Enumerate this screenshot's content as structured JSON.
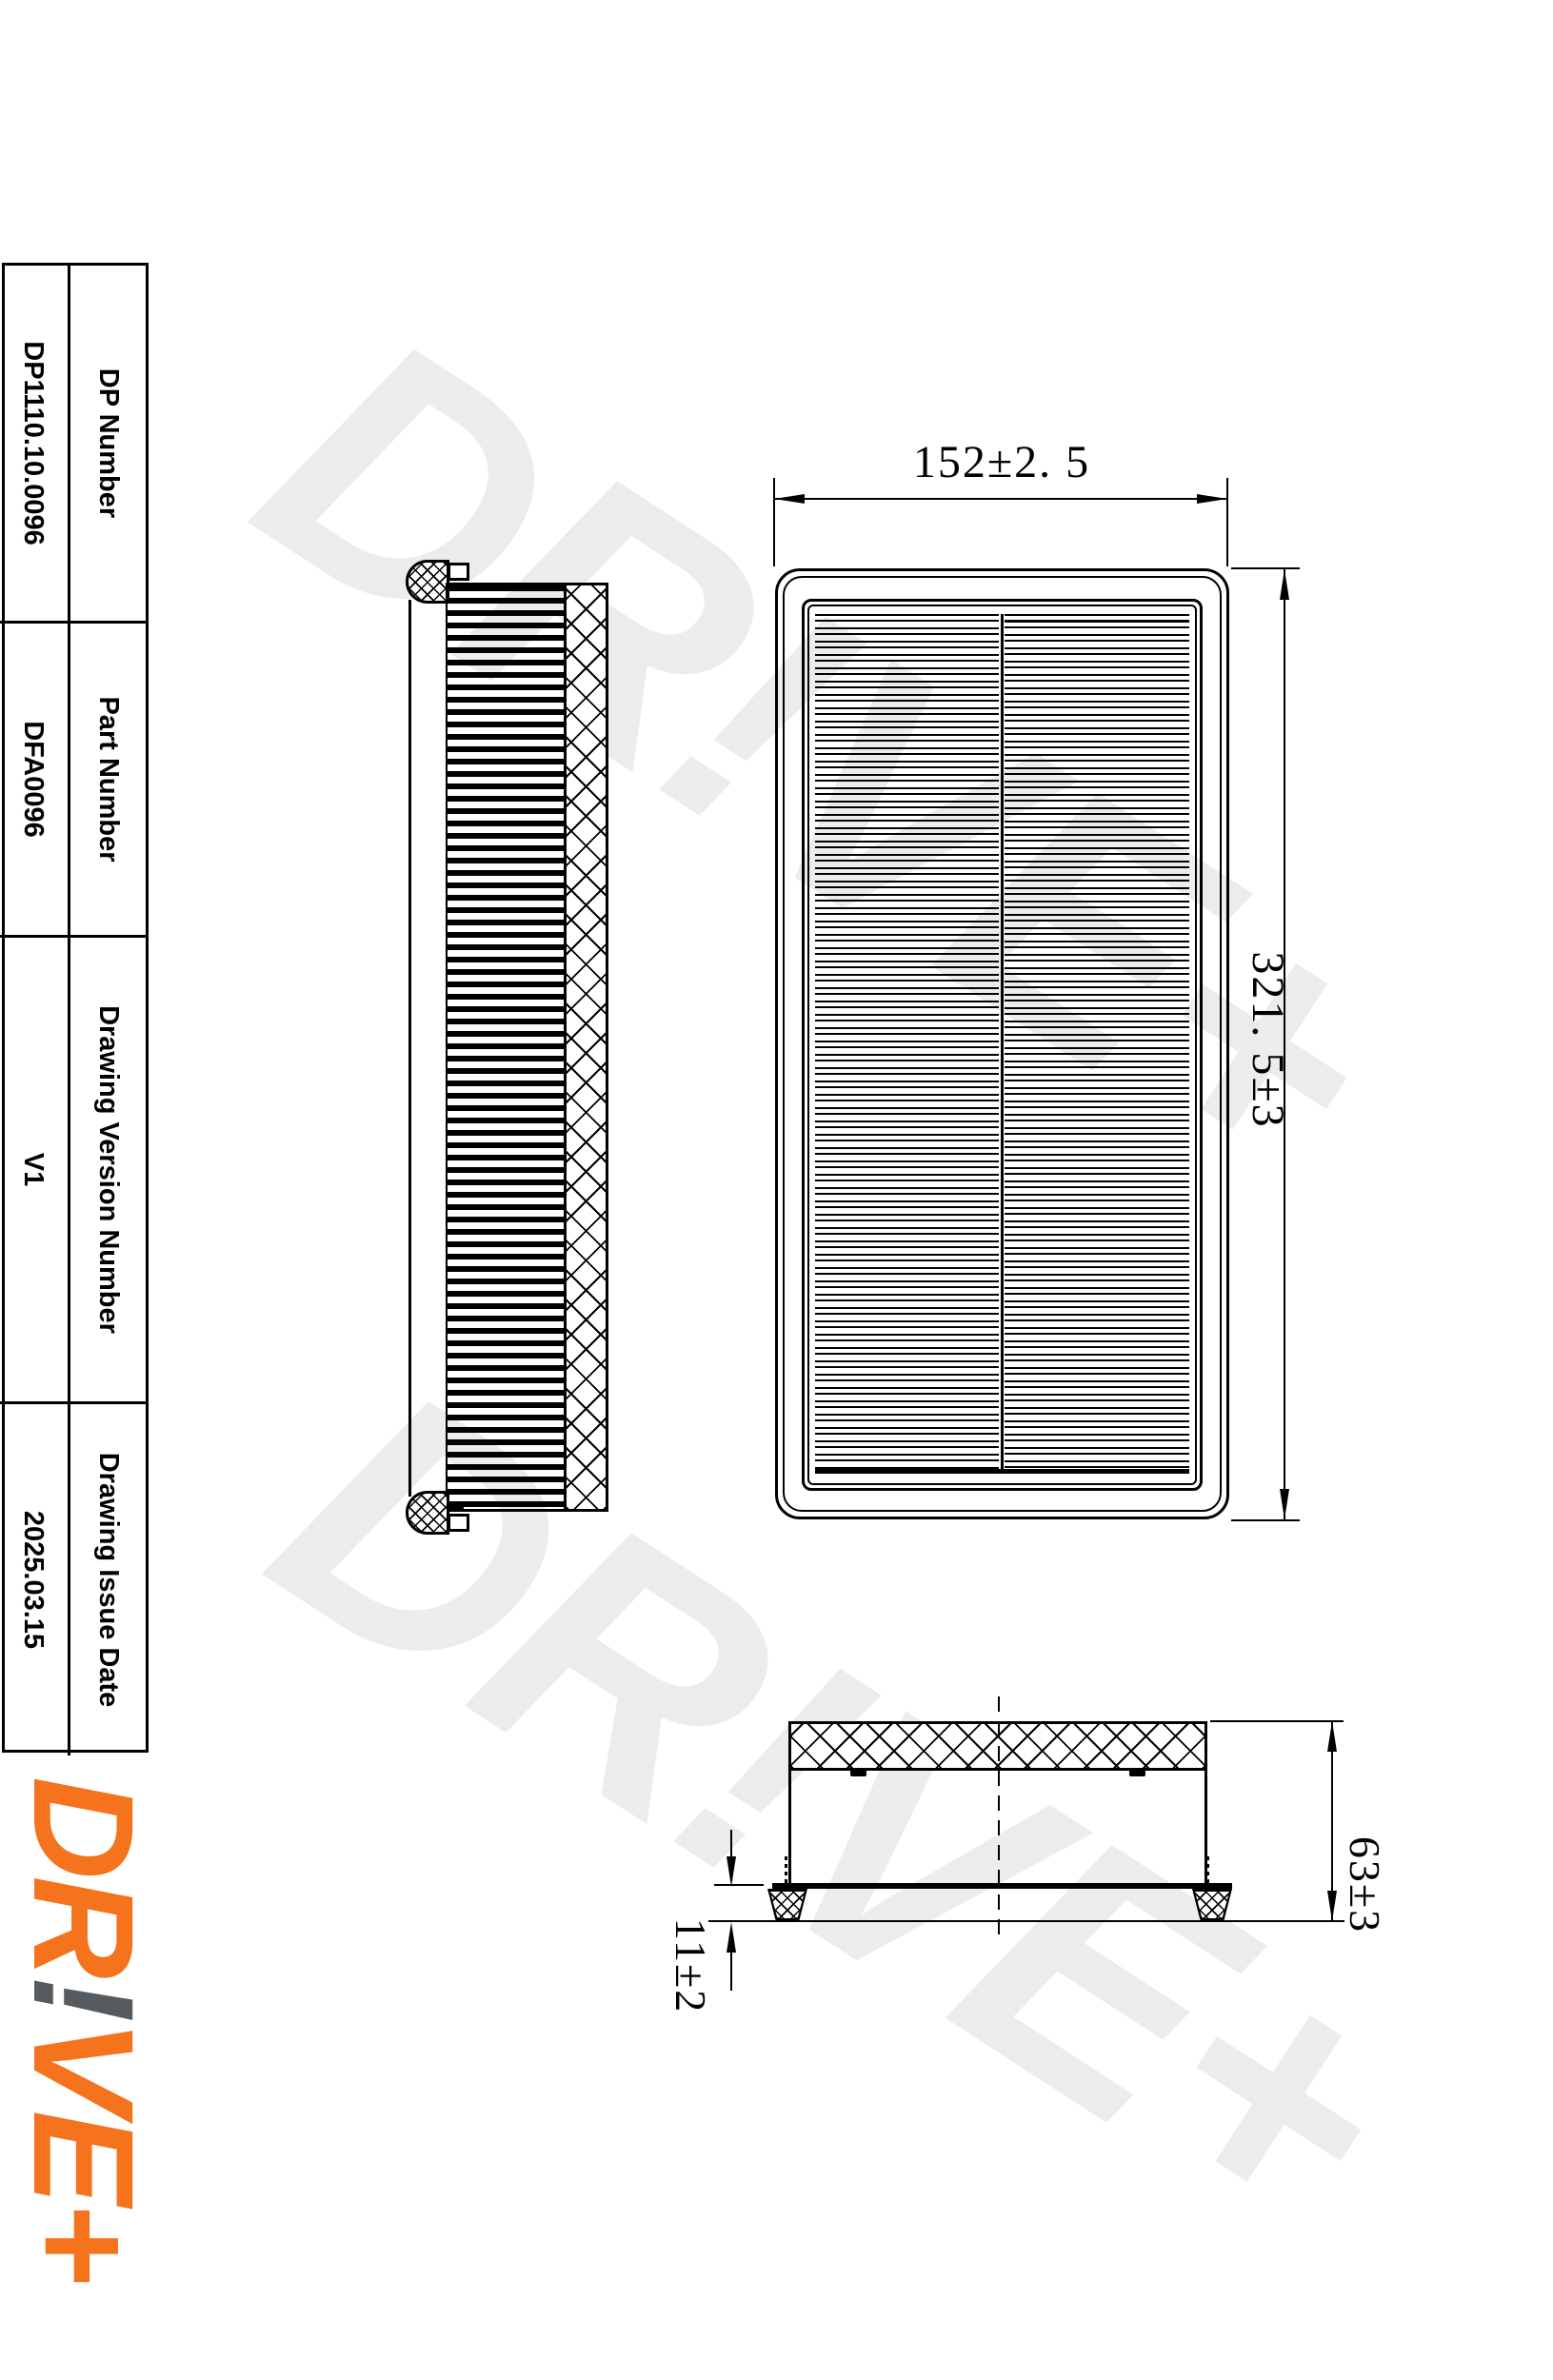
{
  "watermark": {
    "text": "DR!VE+",
    "color": "#ececec"
  },
  "info_table": {
    "rows": [
      {
        "label": "DP Number",
        "value": "DP1110.10.0096"
      },
      {
        "label": "Part Number",
        "value": "DFA0096"
      },
      {
        "label": "Drawing Version Number",
        "value": "V1"
      },
      {
        "label": "Drawing Issue Date",
        "value": "2025.03.15"
      }
    ]
  },
  "logo": {
    "dr": "DR",
    "bang": "!",
    "vep": "VE+",
    "orange_color": "#f4731c",
    "gray_color": "#565b5f"
  },
  "dimensions": {
    "width": "152±2. 5",
    "height": "321. 5±3",
    "depth": "63±3",
    "foot_height": "11±2"
  }
}
